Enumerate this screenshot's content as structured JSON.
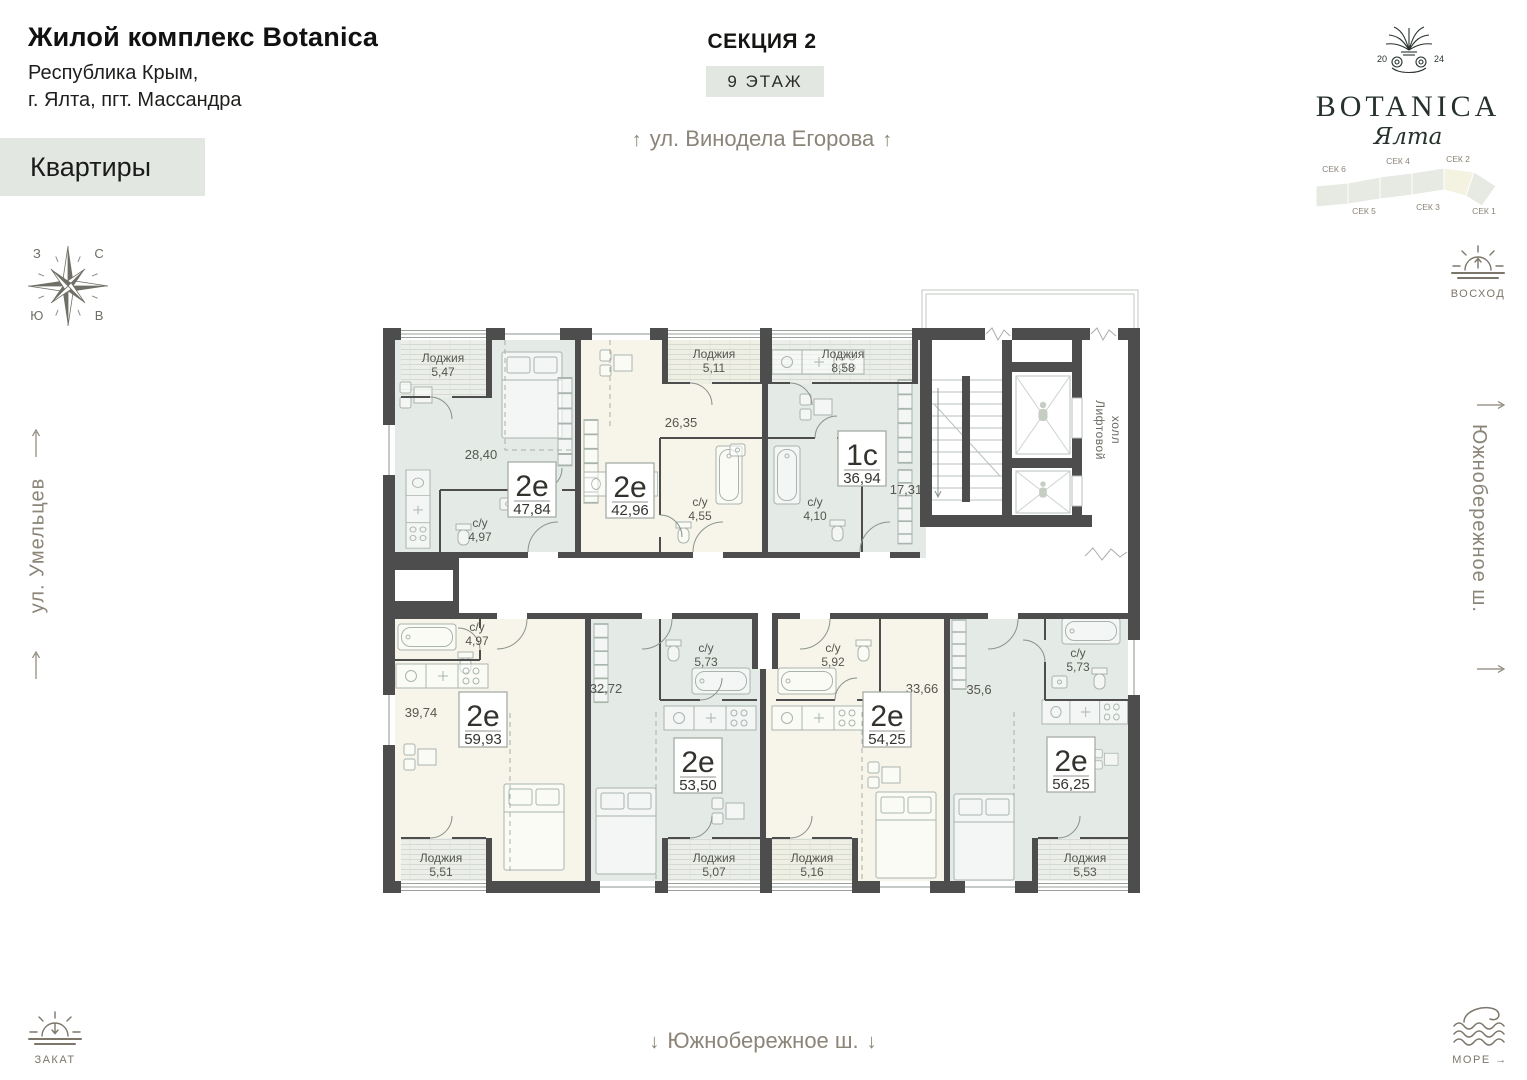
{
  "header": {
    "title": "Жилой комплекс Botanica",
    "address_line1": "Республика Крым,",
    "address_line2": "г. Ялта, пгт. Массандра",
    "apartments_button": "Квартиры"
  },
  "top": {
    "section_title": "СЕКЦИЯ 2",
    "floor_label": "9 ЭТАЖ",
    "street": "ул. Винодела Егорова",
    "arrow_up": "↑"
  },
  "logo": {
    "year_left": "20",
    "year_right": "24",
    "brand": "BOTANICA",
    "city_script": "Ялта"
  },
  "section_map": {
    "labels_top": [
      "СЕК 6",
      "СЕК 4",
      "СЕК 2"
    ],
    "labels_bottom": [
      "СЕК 5",
      "СЕК 3",
      "СЕК 1"
    ],
    "active": "СЕК 2"
  },
  "compass": {
    "north": "С",
    "east": "В",
    "west": "З",
    "south": "Ю"
  },
  "landmarks": {
    "sunrise": "ВОСХОД",
    "sunset": "ЗАКАТ",
    "sea": "МОРЕ",
    "sea_arrow": "→",
    "left_street": "ул. Умельцев",
    "right_street": "Южнобережное ш.",
    "bottom_street": "Южнобережное ш.",
    "down_arrow": "↓",
    "up_arrow": "↑"
  },
  "plan": {
    "lift_hall_line1": "Лифтовой",
    "lift_hall_line2": "холл",
    "apartments": [
      {
        "type": "2е",
        "total": "47,84",
        "room": "28,40",
        "bath_label": "с/у",
        "bath": "4,97",
        "loggia_label": "Лоджия",
        "loggia": "5,47"
      },
      {
        "type": "2е",
        "total": "42,96",
        "room": "26,35",
        "bath_label": "с/у",
        "bath": "4,55",
        "loggia_label": "Лоджия",
        "loggia": "5,11"
      },
      {
        "type": "1с",
        "total": "36,94",
        "room": "17,31",
        "bath_label": "с/у",
        "bath": "4,10",
        "loggia_label": "Лоджия",
        "loggia": "8,58"
      },
      {
        "type": "2е",
        "total": "59,93",
        "room": "39,74",
        "bath_label": "с/у",
        "bath": "4,97",
        "loggia_label": "Лоджия",
        "loggia": "5,51"
      },
      {
        "type": "2е",
        "total": "53,50",
        "room": "32,72",
        "bath_label": "с/у",
        "bath": "5,73",
        "loggia_label": "Лоджия",
        "loggia": "5,07"
      },
      {
        "type": "2е",
        "total": "54,25",
        "room": "33,66",
        "bath_label": "с/у",
        "bath": "5,92",
        "loggia_label": "Лоджия",
        "loggia": "5,16"
      },
      {
        "type": "2е",
        "total": "56,25",
        "room": "35,6",
        "bath_label": "с/у",
        "bath": "5,73",
        "loggia_label": "Лоджия",
        "loggia": "5,53"
      }
    ]
  },
  "colors": {
    "accent_bg": "#e3e7e1",
    "wall": "#4d4d4d",
    "fill_green": "#e4eae6",
    "fill_cream": "#f7f5ea",
    "muted": "#8b8478",
    "logo_green": "#26322b"
  }
}
